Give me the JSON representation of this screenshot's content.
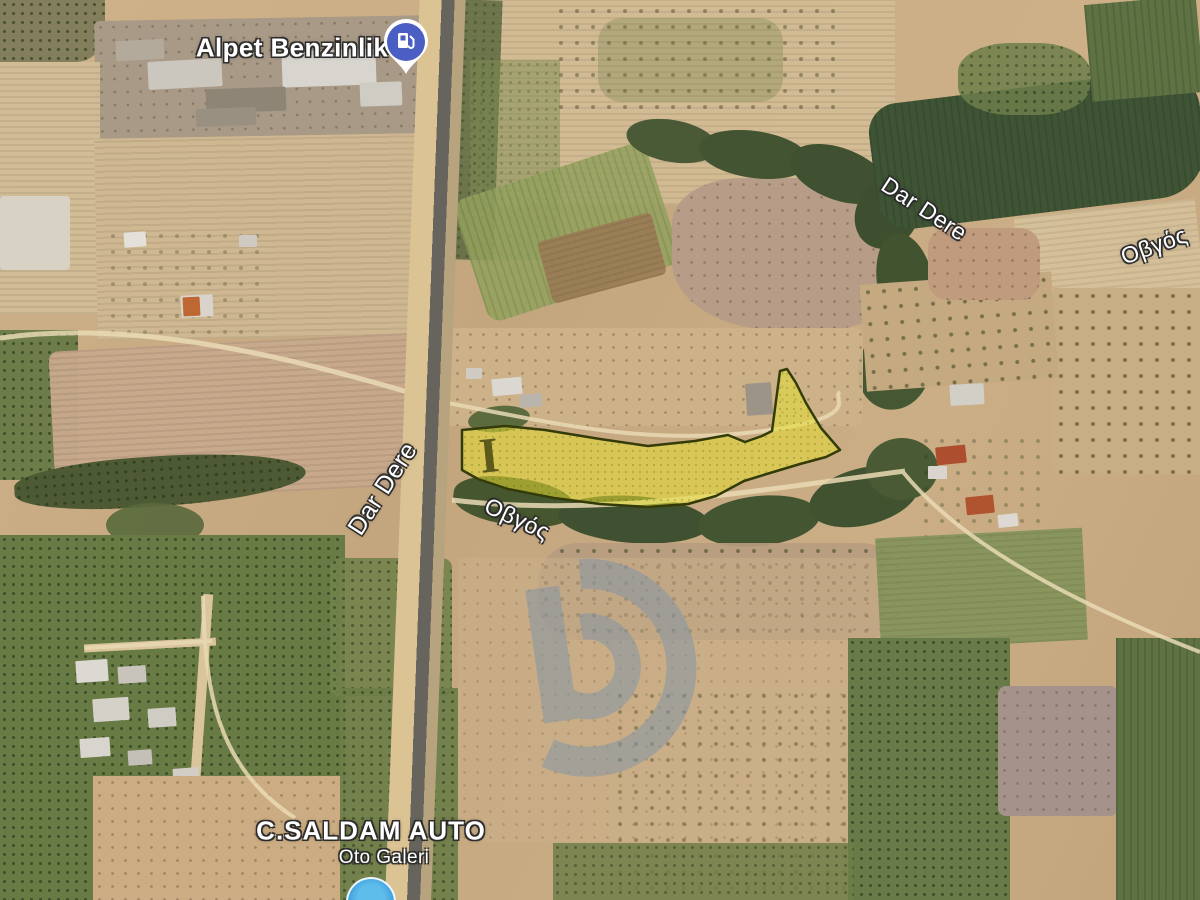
{
  "map": {
    "labels": {
      "gas_station_poi": "Alpet Benzinlik",
      "stream_label_top": "Dar Dere",
      "stream_label_left": "Dar Dere",
      "river_label_right": "Οβγός",
      "river_label_center": "Οβγός",
      "dealer_name": "C.SALDAM AUTO",
      "dealer_type": "Oto Galeri",
      "parcel_marker": "I"
    },
    "icons": {
      "gas_pin": "gas-station-pin",
      "dealer_pin": "dealer-pin",
      "watermark": "b-logo-watermark"
    },
    "colors": {
      "parcel_fill": "#e6df33",
      "parcel_outline": "#333b08",
      "gas_pin_blue": "#4a5ec4",
      "dealer_pin_blue": "#41a8e0",
      "watermark_blue_gray": "#7d94a8"
    }
  }
}
